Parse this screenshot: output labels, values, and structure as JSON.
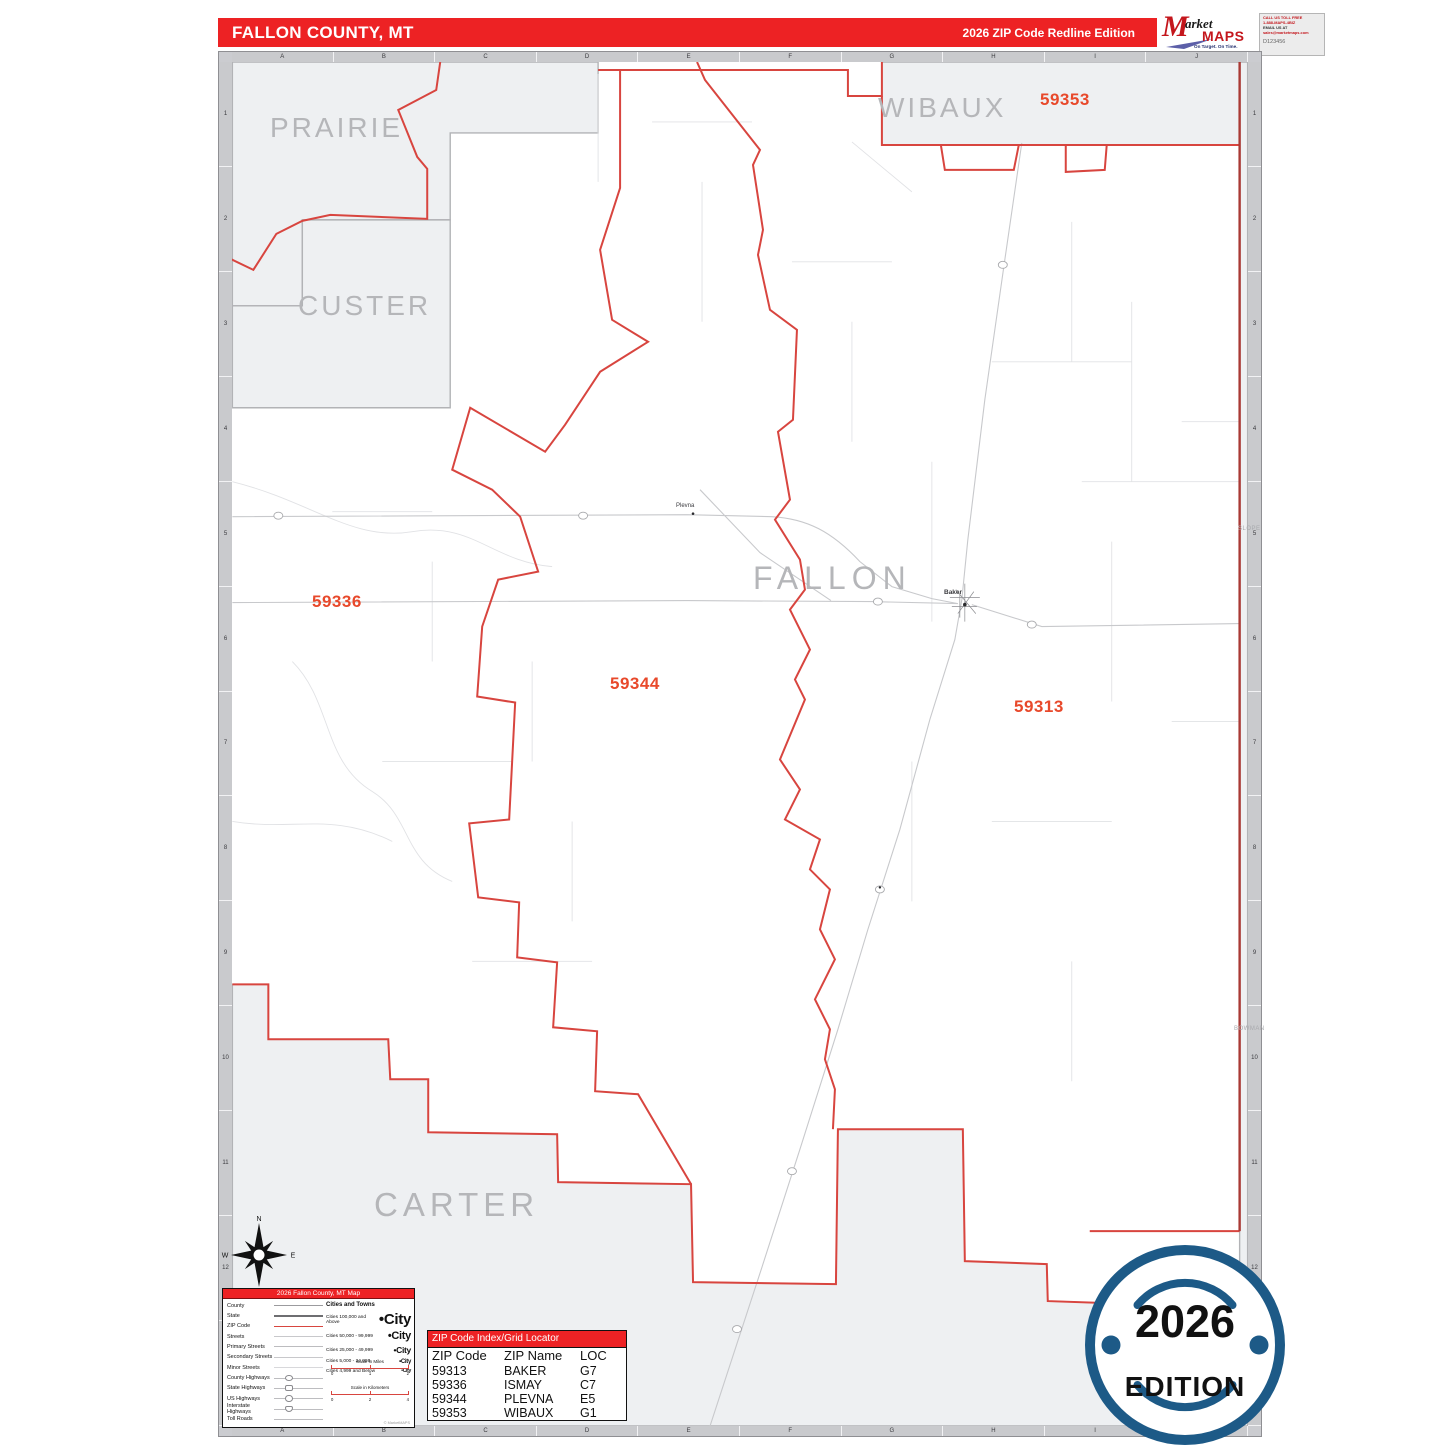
{
  "header": {
    "county_title": "FALLON COUNTY, MT",
    "edition_title": "2026 ZIP Code Redline Edition",
    "logo": {
      "m": "M",
      "market": "arket",
      "maps": "MAPS",
      "tagline": "On Target.  On Time.",
      "subtitle": "America's Leading Source of Business Maps"
    },
    "contact": {
      "line1": "CALL US TOLL FREE",
      "line2": "1-888-MAPS-4BIZ",
      "line3": "EMAIL US AT",
      "line4": "sales@marketmaps.com",
      "code": "D123456"
    }
  },
  "map": {
    "county_name": "FALLON",
    "neighbor_counties": {
      "prairie": "PRAIRIE",
      "custer": "CUSTER",
      "wibaux": "WIBAUX",
      "carter": "CARTER",
      "slope": "SLOPE",
      "bowman": "BOWMAN"
    },
    "zip_labels": {
      "z59353": "59353",
      "z59336": "59336",
      "z59344": "59344",
      "z59313": "59313"
    },
    "cities": {
      "baker": "Baker",
      "plevna": "Plevna"
    },
    "grid": {
      "columns": [
        "A",
        "B",
        "C",
        "D",
        "E",
        "F",
        "G",
        "H",
        "I",
        "J"
      ],
      "rows": [
        "1",
        "2",
        "3",
        "4",
        "5",
        "6",
        "7",
        "8",
        "9",
        "10",
        "11",
        "12",
        "13"
      ]
    },
    "compass": {
      "n": "N",
      "e": "E",
      "s": "S",
      "w": "W"
    }
  },
  "legend": {
    "title": "2026 Fallon County, MT Map",
    "line_items": [
      "County",
      "State",
      "ZIP Code",
      "Streets",
      "Primary Streets",
      "Secondary Streets",
      "Minor Streets",
      "County Highways",
      "State Highways",
      "US Highways",
      "Interstate Highways",
      "Toll Roads"
    ],
    "cities_header": "Cities and Towns",
    "city_classes": [
      {
        "label": "Cities 100,000 and Above",
        "sample": "•City",
        "size": 15
      },
      {
        "label": "Cities 50,000 - 99,999",
        "sample": "•City",
        "size": 11
      },
      {
        "label": "Cities 25,000 - 49,999",
        "sample": "•City",
        "size": 8.5
      },
      {
        "label": "Cities 5,000 - 24,999",
        "sample": "•City",
        "size": 6
      },
      {
        "label": "Cities 4,999 and Below",
        "sample": "•City",
        "size": 5
      }
    ],
    "scale_miles": {
      "title": "Scale in Miles",
      "ticks": [
        "0",
        "1",
        "2"
      ]
    },
    "scale_km": {
      "title": "Scale in Kilometers",
      "ticks": [
        "0",
        "2",
        "4"
      ]
    },
    "copyright": "© MarketMAPS"
  },
  "zip_index": {
    "title": "ZIP Code Index/Grid Locator",
    "columns": [
      "ZIP Code",
      "ZIP Name",
      "LOC"
    ],
    "rows": [
      [
        "59313",
        "BAKER",
        "G7"
      ],
      [
        "59336",
        "ISMAY",
        "C7"
      ],
      [
        "59344",
        "PLEVNA",
        "E5"
      ],
      [
        "59353",
        "WIBAUX",
        "G1"
      ]
    ]
  },
  "badge": {
    "year": "2026",
    "label": "EDITION"
  },
  "colors": {
    "header_red": "#ed2224",
    "zip_label_orange": "#e8492b",
    "boundary_red": "#d8453f",
    "state_line_red": "#a93a35",
    "badge_navy": "#1d5a87",
    "outside_county_fill": "#eef0f2",
    "county_label_gray": "#b5b6b9"
  }
}
